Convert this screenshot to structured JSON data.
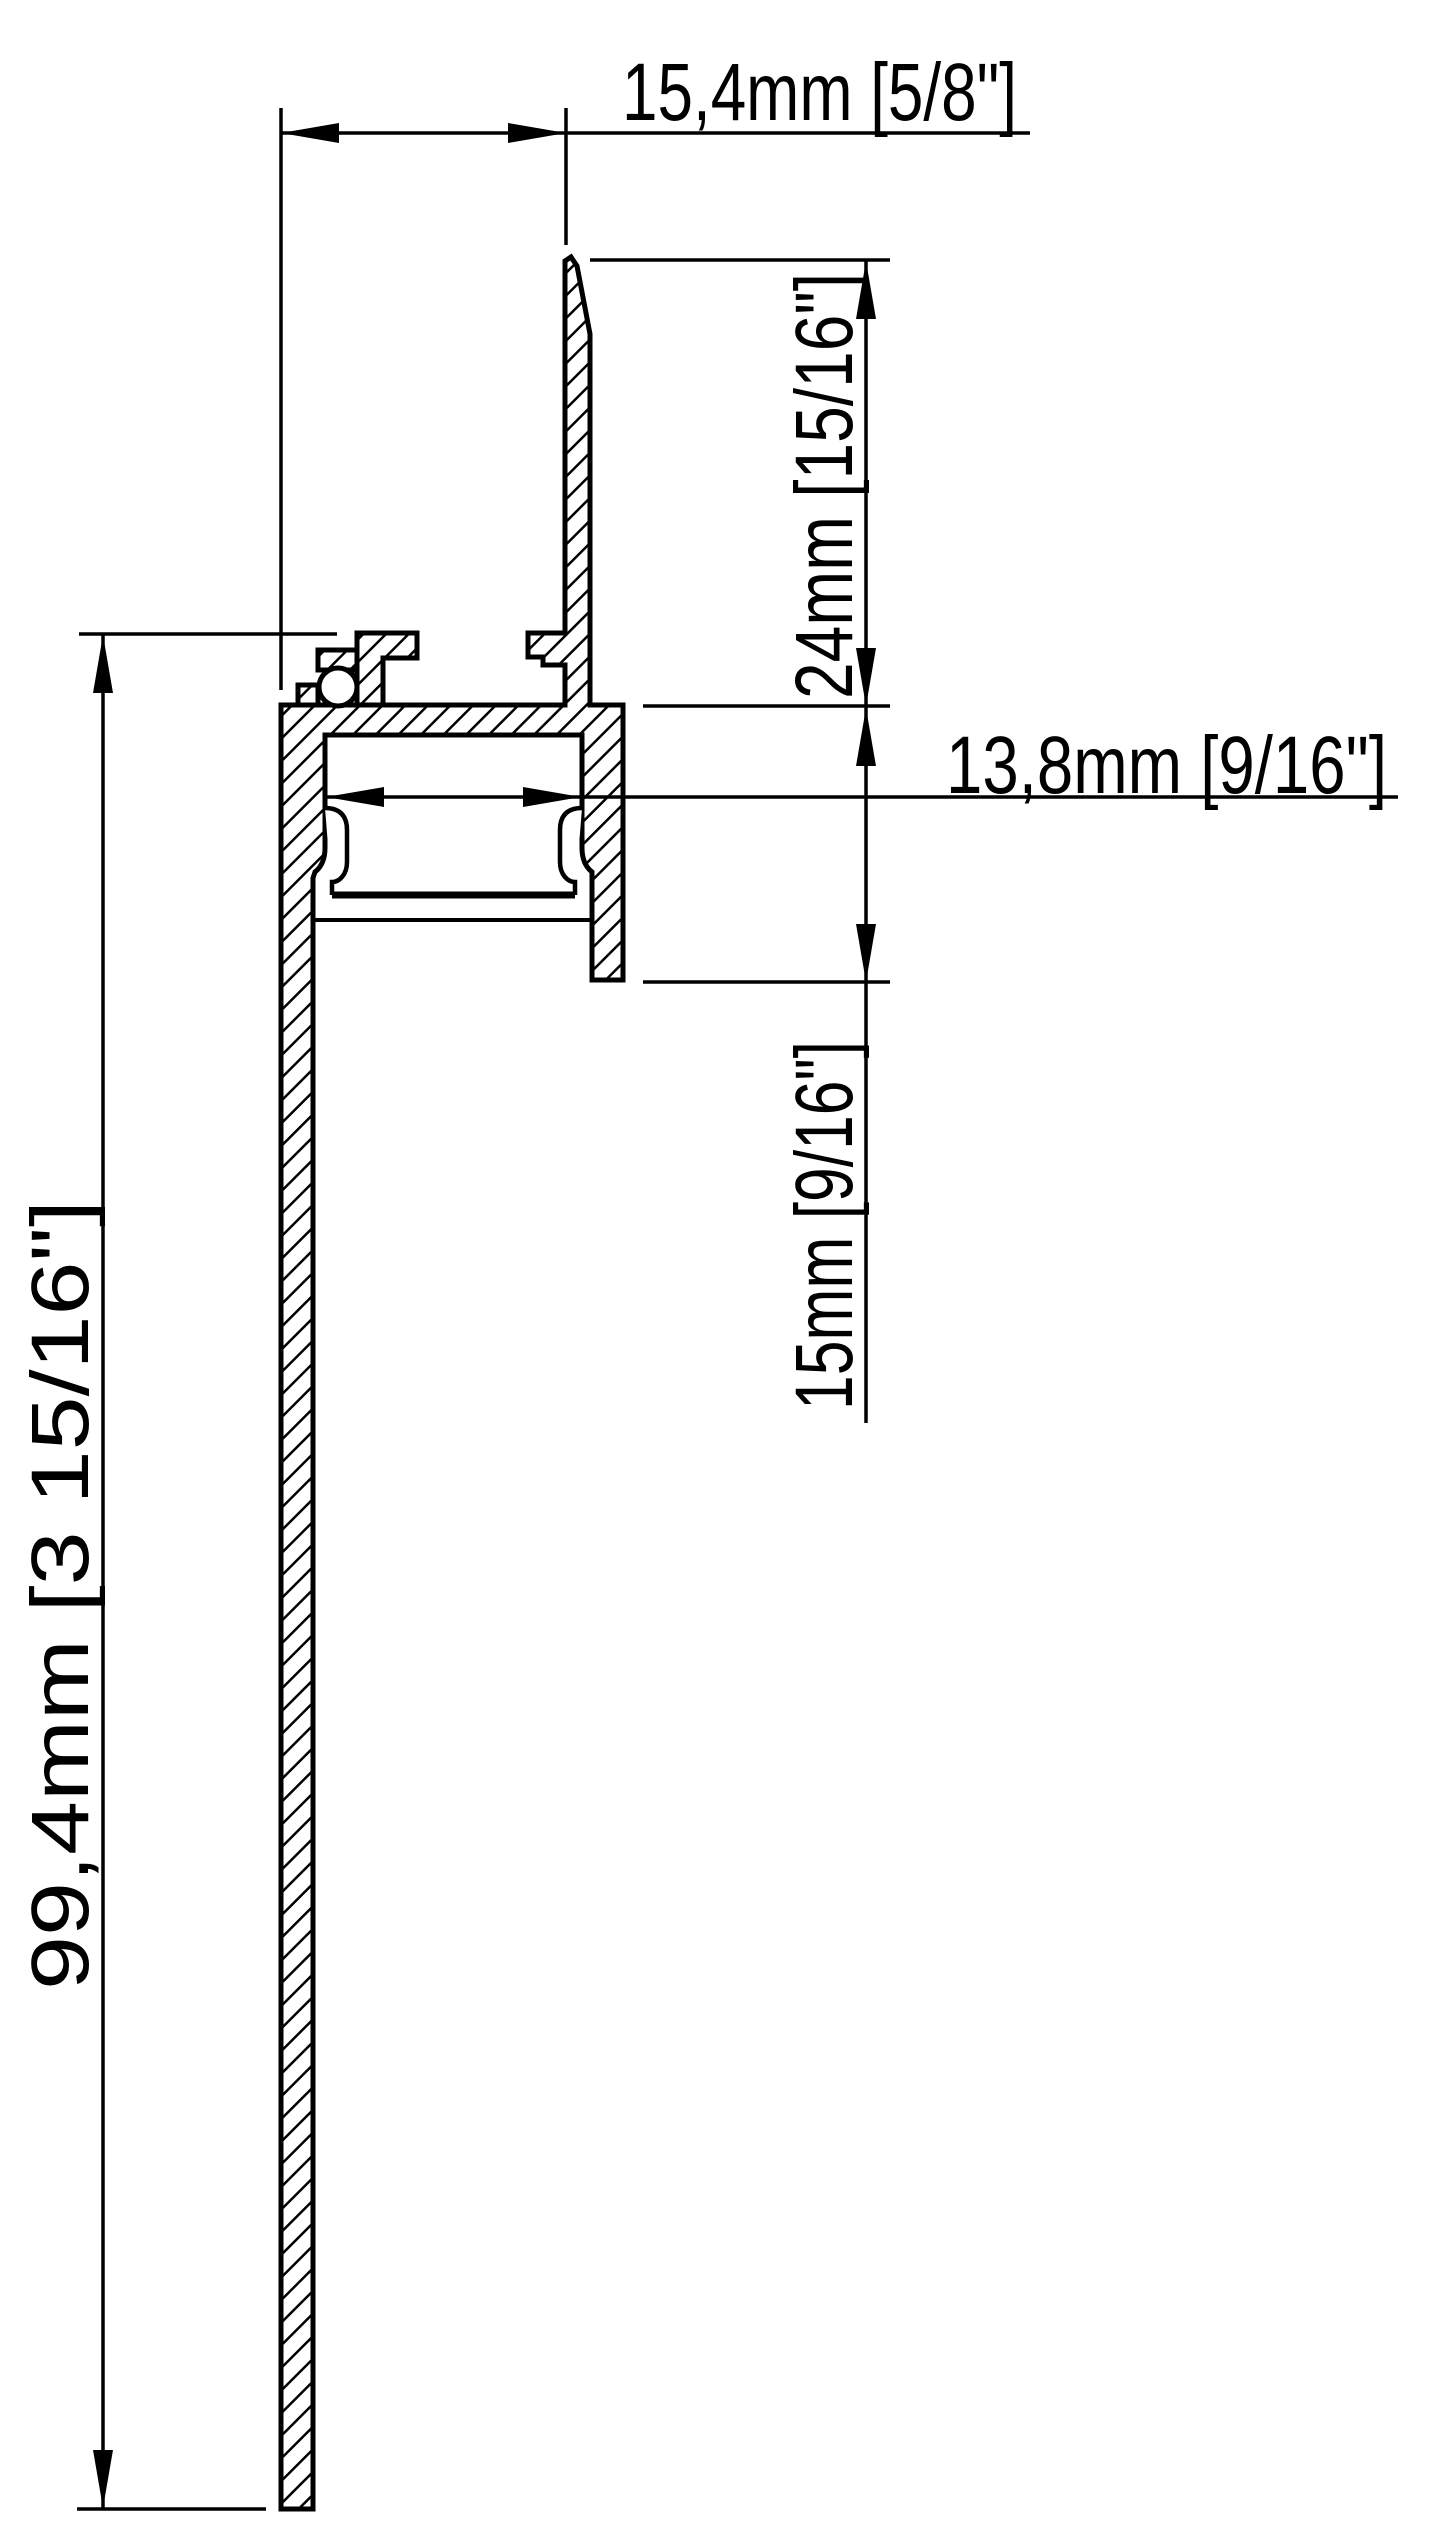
{
  "drawing": {
    "title": "LED plaster-in profile cross-section",
    "colors": {
      "line": "#000000",
      "background": "#ffffff"
    },
    "dimensions": {
      "top_width": {
        "label": "15,4mm [5/8\"]",
        "orientation": "horizontal"
      },
      "fin_height": {
        "label": "24mm [15/16\"]",
        "orientation": "vertical"
      },
      "inner_width": {
        "label": "13,8mm [9/16\"]",
        "orientation": "horizontal"
      },
      "flange_depth": {
        "label": "15mm [9/16\"]",
        "orientation": "vertical"
      },
      "overall_height": {
        "label": "99,4mm [3 15/16\"]",
        "orientation": "vertical"
      }
    }
  }
}
